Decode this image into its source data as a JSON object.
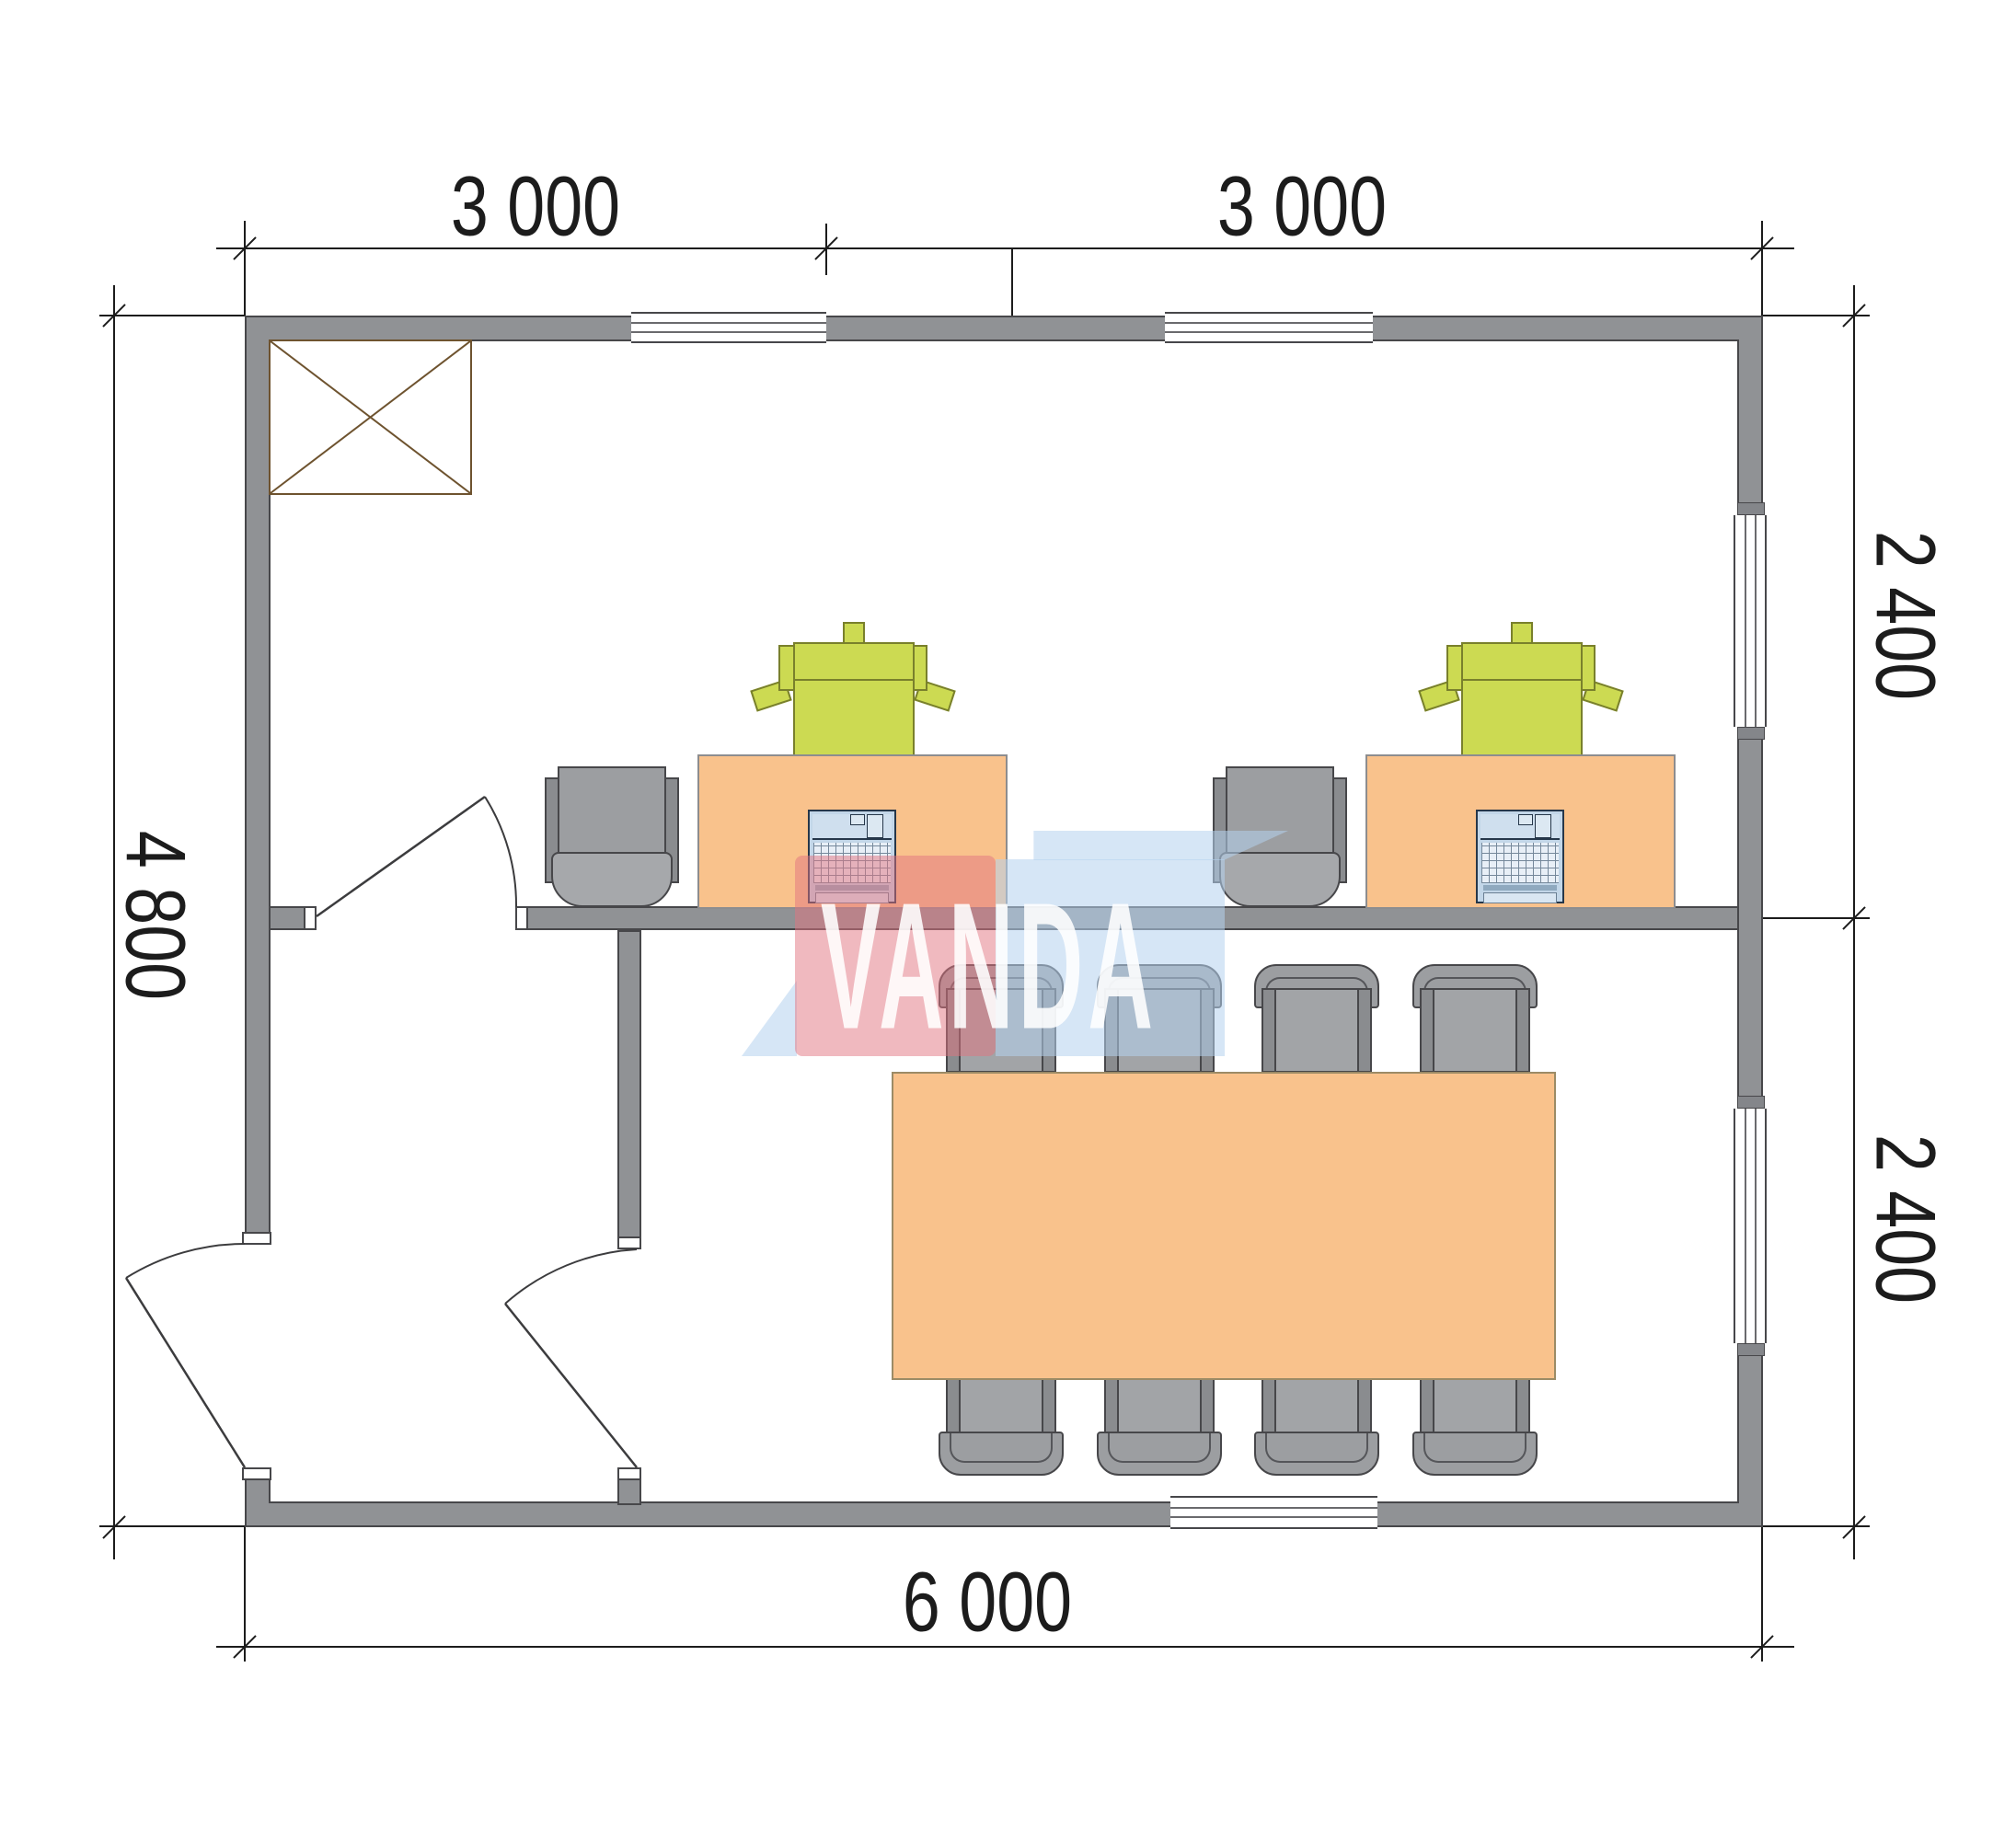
{
  "title": "office-floor-plan",
  "dimensions": {
    "top_left": "3 000",
    "top_right": "3 000",
    "right_upper": "2 400",
    "right_lower": "2 400",
    "left": "4 800",
    "bottom": "6 000"
  },
  "watermark": {
    "text": "VANDA",
    "pink_color": "#e2737f",
    "blue_color": "#b4d2ef"
  },
  "plan": {
    "building_width_mm": 6000,
    "building_depth_mm": 4800,
    "bay_width_mm": 3000,
    "room_depth_mm": 2400,
    "wall_color": "#909295",
    "rooms": [
      {
        "name": "office",
        "furniture": [
          "cabinet-with-cross",
          "desk",
          "desk",
          "office-chair",
          "office-chair",
          "printer",
          "printer",
          "laptop",
          "laptop"
        ]
      },
      {
        "name": "entrance-hall",
        "furniture": []
      },
      {
        "name": "meeting-room",
        "furniture": [
          "conference-table",
          "chair",
          "chair",
          "chair",
          "chair",
          "chair",
          "chair",
          "chair",
          "chair"
        ]
      }
    ],
    "doors": [
      "entrance-door-left-wall",
      "hall-to-office-door",
      "hall-to-meeting-room-door"
    ],
    "windows": [
      "top-wall-left",
      "top-wall-right",
      "right-wall-upper",
      "right-wall-lower",
      "bottom-wall"
    ],
    "furniture_colors": {
      "wood": "#f9c28c",
      "printer": "#ccda52",
      "laptop": "#c2d6e8",
      "chair": "#9c9ea1",
      "cabinet": "#c9ab81"
    }
  }
}
